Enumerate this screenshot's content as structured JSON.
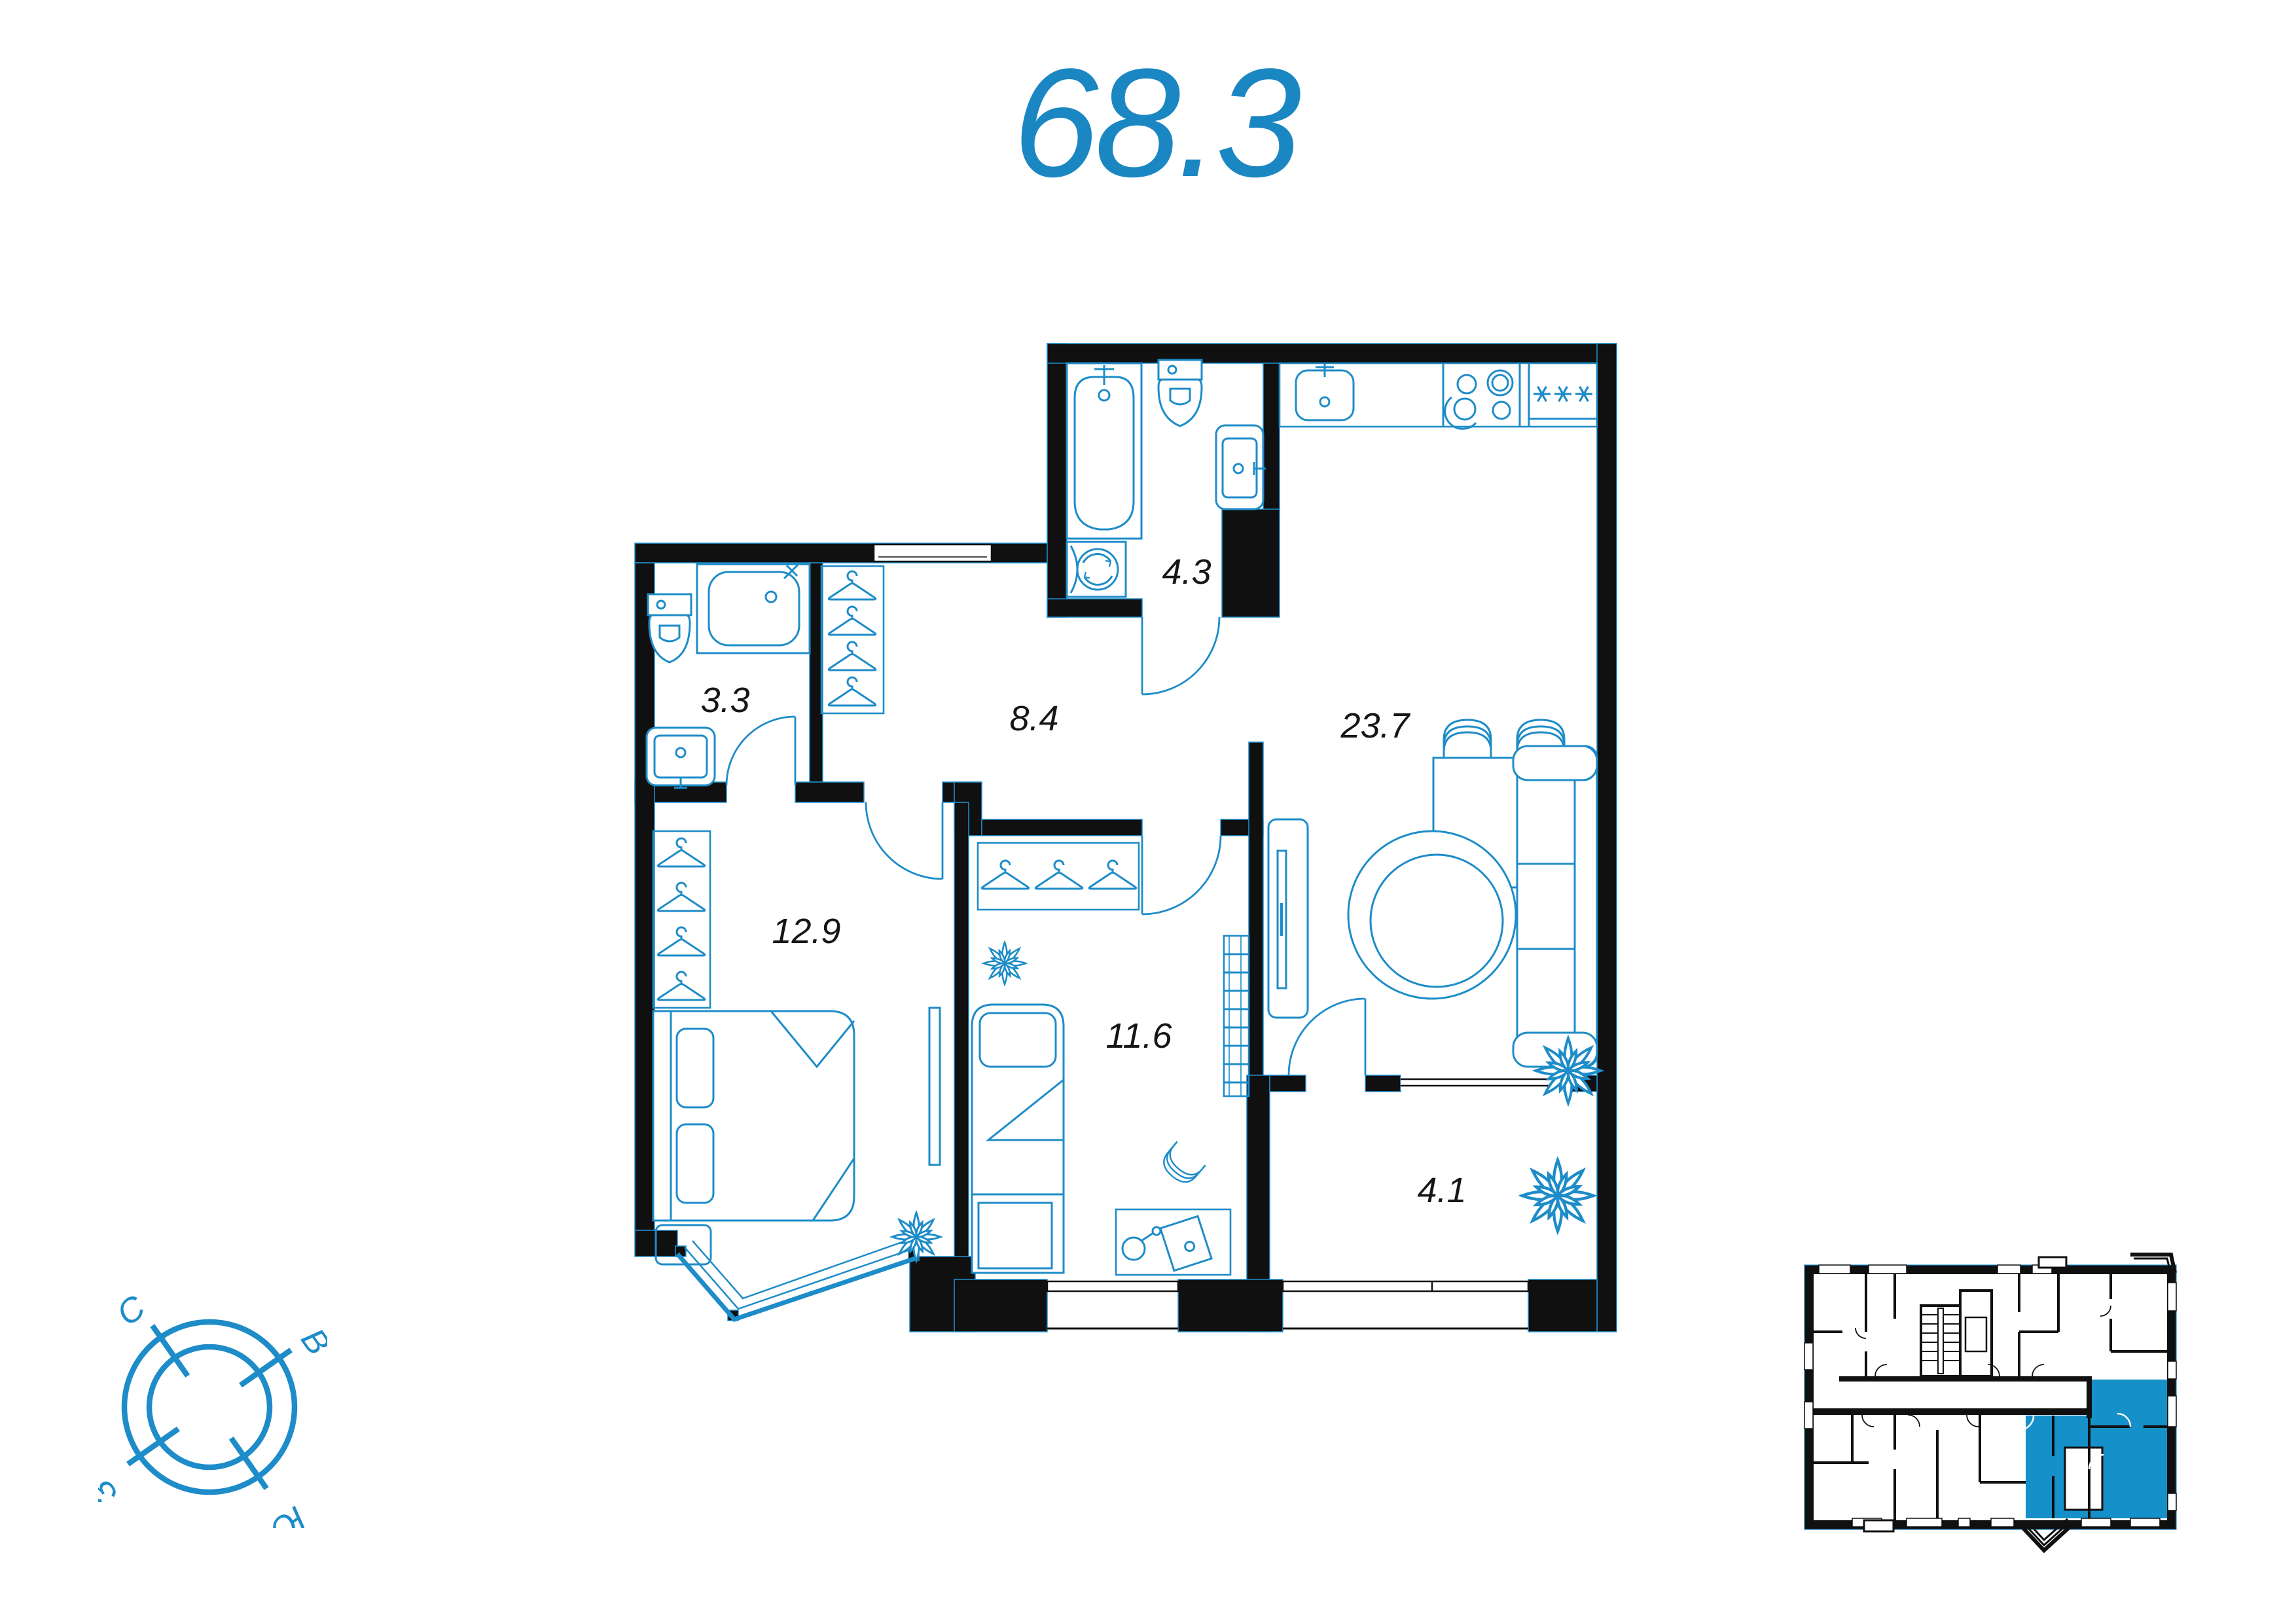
{
  "page": {
    "title_area": "68.3"
  },
  "floor_plan": {
    "rooms": [
      {
        "name": "bathroom-small",
        "area": "3.3"
      },
      {
        "name": "hallway",
        "area": "8.4"
      },
      {
        "name": "bathroom-big",
        "area": "4.3"
      },
      {
        "name": "living-kitchen",
        "area": "23.7"
      },
      {
        "name": "bedroom",
        "area": "12.9"
      },
      {
        "name": "bedroom-2",
        "area": "11.6"
      },
      {
        "name": "loggia",
        "area": "4.1"
      }
    ]
  },
  "compass": {
    "north_label": "С",
    "east_label": "В",
    "west_label": "З",
    "south_label": "Ю"
  },
  "colors": {
    "accent_blue_fill": "#1590c9",
    "fixture_line_blue": "#1e8cc8",
    "title_blue": "#1b87c2",
    "wall_black": "#101010"
  }
}
